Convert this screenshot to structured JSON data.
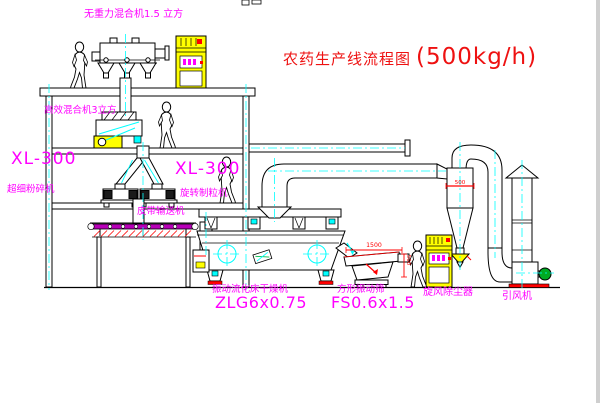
{
  "title": {
    "name": "农药生产线流程图",
    "capacity": "(500kg/h)"
  },
  "labels": {
    "gravity_mixer": "无重力混合机1.5 立方",
    "high_mixer": "高效混合机3立方",
    "mill_model": "XL-300",
    "mill_name": "超细粉碎机",
    "granulator_model": "XL-300",
    "granulator_name": "旋转制粒机",
    "belt_conveyor": "皮带输送机",
    "dryer_name": "振动流化床干燥机",
    "dryer_model": "ZLG6x0.75",
    "screen_name": "方形振动筛",
    "screen_model": "FS0.6x1.5",
    "cyclone": "旋风除尘器",
    "fan": "引风机"
  },
  "dimensions": {
    "screen_length": "1500",
    "screen_side": "500",
    "cyclone_width": "500"
  },
  "colors": {
    "label_magenta": "#ff00ff",
    "title_red": "#ee1111",
    "centerline_cyan": "#00ffff",
    "cabinet_yellow": "#ffff00",
    "accent_red": "#ff0000",
    "motor_green": "#00aa22",
    "belt_magenta": "#b800b8"
  }
}
